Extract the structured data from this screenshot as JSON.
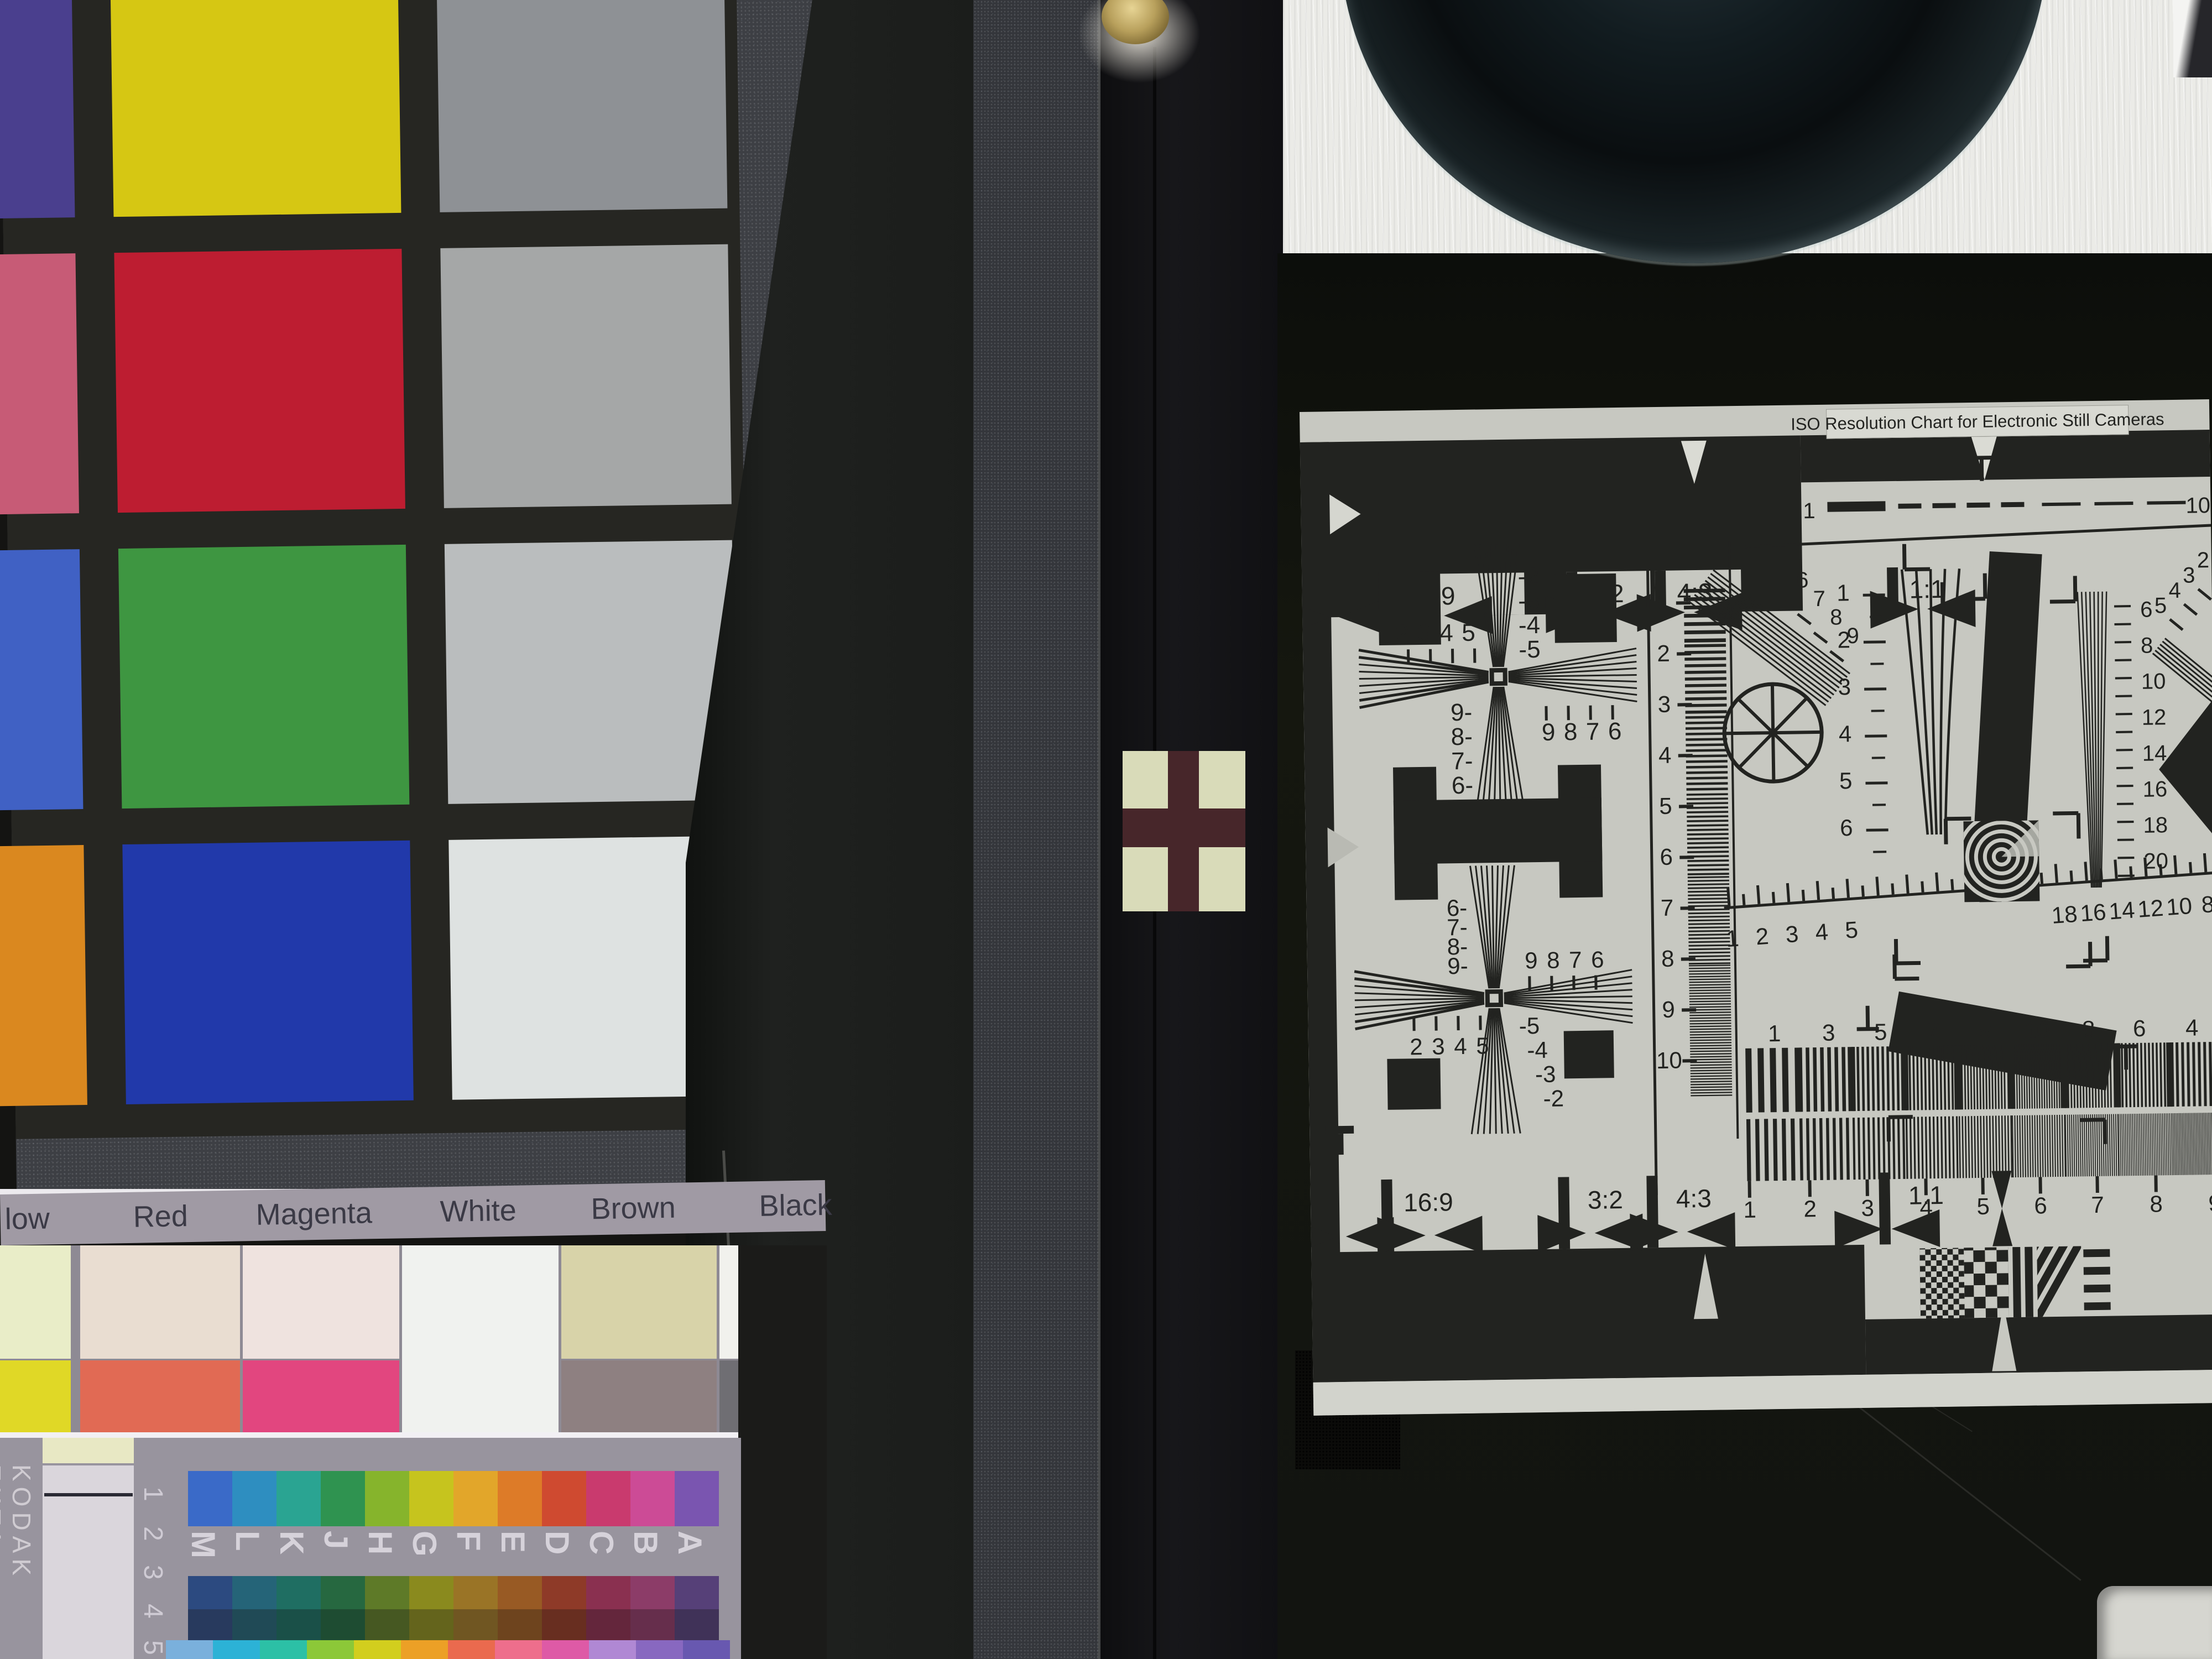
{
  "iso_chart": {
    "title": "ISO Resolution Chart for Electronic Still Cameras",
    "aspect_labels": [
      "16:9",
      "3:2",
      "4:3",
      "1:1"
    ],
    "top_dash_scale": {
      "start": "1",
      "end": "10"
    },
    "vertical_ruler_numbers": [
      "1",
      "2",
      "3",
      "4",
      "5",
      "6",
      "7",
      "8",
      "9",
      "10"
    ],
    "diag_wedge_numbers": [
      "6",
      "7",
      "8",
      "9"
    ],
    "right_scale_numbers": [
      "1",
      "2",
      "3",
      "4",
      "5",
      "6"
    ],
    "fine_scale_numbers": [
      "6",
      "8",
      "10",
      "12",
      "14",
      "16",
      "18",
      "20"
    ],
    "corner_diag_numbers": [
      "5",
      "4",
      "3",
      "2"
    ],
    "cross1": {
      "top_numbers": [
        "2",
        "3",
        "4",
        "5"
      ],
      "right_numbers": [
        "-2",
        "-3",
        "-4",
        "-5"
      ],
      "left_numbers": [
        "9-",
        "8-",
        "7-",
        "6-"
      ],
      "bottom_numbers": [
        "9",
        "8",
        "7",
        "6"
      ]
    },
    "cross2": {
      "left_numbers": [
        "6-",
        "7-",
        "8-",
        "9-"
      ],
      "top_numbers": [
        "9",
        "8",
        "7",
        "6"
      ],
      "bottom_numbers": [
        "2",
        "3",
        "4",
        "5"
      ],
      "right_numbers": [
        "-5",
        "-4",
        "-3",
        "-2"
      ]
    },
    "mid_ruler_left_numbers": [
      "1",
      "2",
      "3",
      "4",
      "5"
    ],
    "mid_ruler_right_numbers": [
      "18",
      "16",
      "14",
      "12",
      "10",
      "8"
    ],
    "band1_numbers": [
      "1",
      "3",
      "5",
      "7",
      "9",
      "10",
      "8",
      "6",
      "4"
    ],
    "band2_numbers": [
      "1",
      "2",
      "3",
      "4",
      "5",
      "6",
      "7",
      "8",
      "9"
    ],
    "ink_color": "#222320",
    "paper_color": "#c7c8c1"
  },
  "color_checker": {
    "rows": [
      [
        "#4a3f8e",
        "#d6c713",
        "#8e9195"
      ],
      [
        "#c75b76",
        "#bd1d31",
        "#a5a7a7"
      ],
      [
        "#4061c4",
        "#3e9641",
        "#babdbe"
      ],
      [
        "#da881f",
        "#2139aa",
        "#dee2e1"
      ]
    ]
  },
  "label_chart": {
    "labels": [
      "low",
      "Red",
      "Magenta",
      "White",
      "Brown",
      "Black"
    ],
    "pale_colors": [
      "#e9edc8",
      "#e9ddd1",
      "#efe3df",
      "#f0f2ef",
      "#d8d3a9",
      "#f1f1ed"
    ],
    "sat_colors": [
      "#e0d826",
      "#e16a54",
      "#e2467f",
      "#f0f2ef",
      "#8e8081",
      "#6f6e73"
    ]
  },
  "kodak": {
    "title": "KODAK EKTA",
    "letters": [
      "A",
      "B",
      "C",
      "D",
      "E",
      "F",
      "G",
      "H",
      "J",
      "K",
      "L",
      "M"
    ],
    "numbers": [
      "1",
      "2",
      "3",
      "4",
      "5"
    ],
    "bright_colors": [
      "#3a6ac8",
      "#2e8ec0",
      "#2aa492",
      "#2f9350",
      "#86b42c",
      "#c6c41e",
      "#e2a62a",
      "#dd7b28",
      "#cf4a30",
      "#c93a6e",
      "#cc4b96",
      "#7a55b0"
    ],
    "dark1_colors": [
      "#2c4a80",
      "#256478",
      "#1f6e62",
      "#266840",
      "#5e7a28",
      "#8a8a1e",
      "#9a7426",
      "#985a24",
      "#8e3a28",
      "#8a3050",
      "#8c3c68",
      "#564078"
    ],
    "dark2_colors": [
      "#283a5e",
      "#204a56",
      "#1a5048",
      "#1e4c32",
      "#465822",
      "#64641c",
      "#705622",
      "#6e441e",
      "#682e20",
      "#64263c",
      "#662e4c",
      "#403258"
    ],
    "sliver_colors": [
      "#7ab0dc",
      "#2cb2d6",
      "#2cc0a6",
      "#8cc838",
      "#d2ce1e",
      "#eca026",
      "#ea6a4e",
      "#ee6e8c",
      "#de5aa6",
      "#b088d4",
      "#8868c0",
      "#6858b0"
    ]
  },
  "scene_colors": {
    "brass_knob": "#b8a05c",
    "sticker_pale": "#d9dbb9",
    "sticker_cross": "#47262a",
    "panel_black": "#131510",
    "strip_black": "#1d1f1d"
  }
}
